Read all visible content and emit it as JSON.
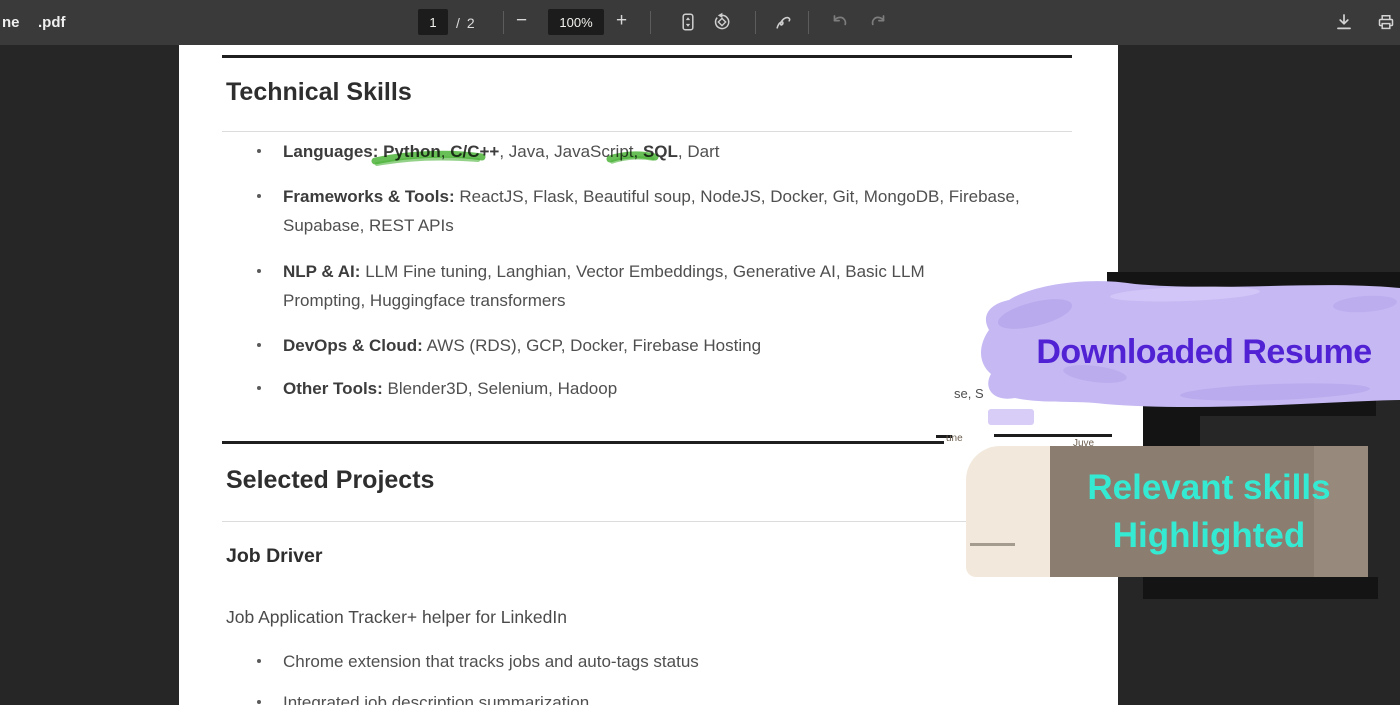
{
  "toolbar": {
    "filename_left": "ne",
    "filename": ".pdf",
    "page_current": "1",
    "page_separator": "/",
    "page_total": "2",
    "minus": "−",
    "zoom_level": "100%",
    "plus": "+",
    "icons": [
      "fit-to-page",
      "rotate",
      "annotate-pen",
      "undo",
      "redo",
      "download",
      "print"
    ]
  },
  "resume": {
    "section1_title": "Technical Skills",
    "languages": {
      "label": "Languages:",
      "bold1": "Python",
      "sep1": ", ",
      "bold2": "C/C++",
      "mid": ", Java, JavaScript, ",
      "bold3": "SQL",
      "tail": ", Dart"
    },
    "skills": [
      {
        "label": "Frameworks & Tools:",
        "text": "ReactJS, Flask, Beautiful soup, NodeJS, Docker, Git, MongoDB, Firebase, Supabase, REST APIs"
      },
      {
        "label": "NLP & AI:",
        "text": "LLM Fine tuning, Langhian, Vector Embeddings, Generative AI, Basic LLM Prompting, Huggingface transformers"
      },
      {
        "label": "DevOps & Cloud:",
        "text": "AWS (RDS), GCP, Docker, Firebase Hosting"
      },
      {
        "label": "Other Tools:",
        "text": "Blender3D, Selenium, Hadoop"
      }
    ],
    "section2_title": "Selected Projects",
    "project_title": "Job Driver",
    "project_subtitle": "Job Application Tracker+ helper for LinkedIn",
    "project_bullets": [
      "Chrome extension that tracks jobs and auto-tags status",
      "Integrated job description summarization"
    ]
  },
  "annotations": {
    "downloaded_label": "Downloaded Resume",
    "relevant_line1": "Relevant skills",
    "relevant_line2": "Highlighted",
    "colors": {
      "highlight_purple": "#c6b8f3",
      "purple_text": "#5122d4",
      "teal_text": "#35ead2",
      "label_brown": "#8b7e70",
      "marker_green": "#4db43a"
    }
  },
  "overlay_fragments": {
    "frag1": "se, S",
    "frag2": "une",
    "frag3": "Juve"
  }
}
